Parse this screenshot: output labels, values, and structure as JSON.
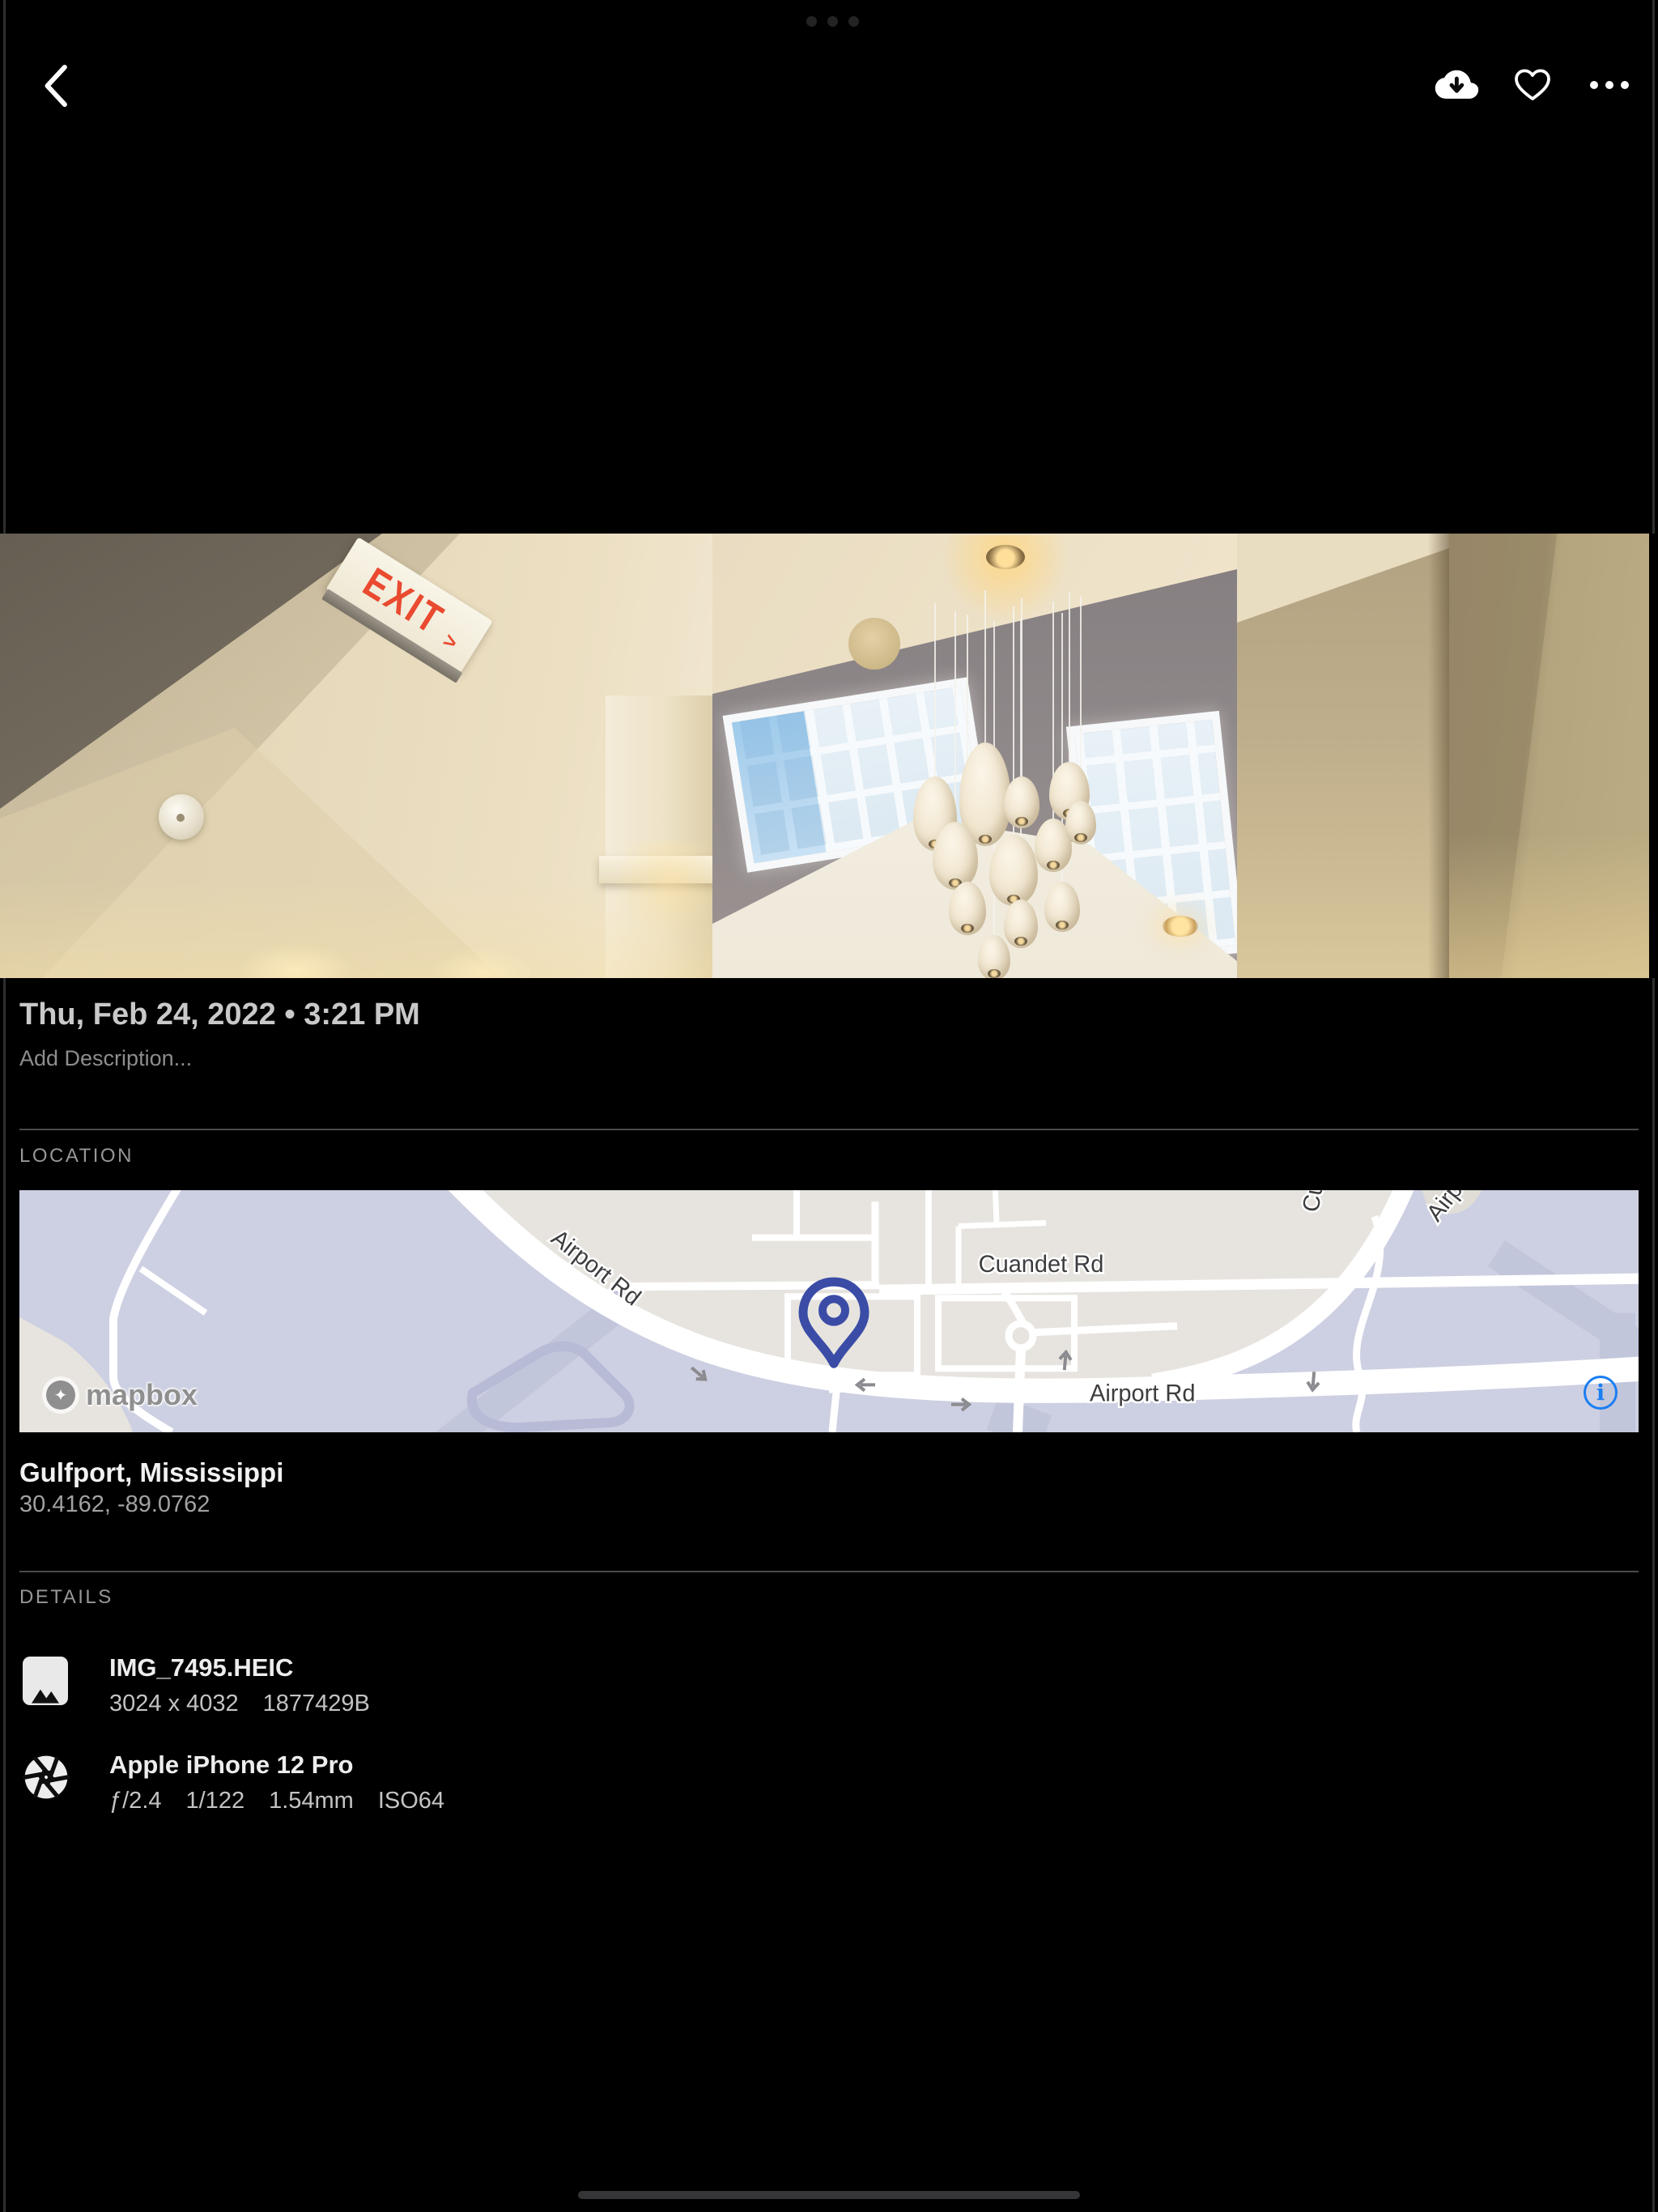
{
  "icons": {
    "back": "chevron-left",
    "download": "cloud-download",
    "favorite": "heart-outline",
    "more": "ellipsis-horizontal",
    "file": "image-thumbnail",
    "camera": "aperture",
    "map_info": "info-circle"
  },
  "photo": {
    "exit_sign": {
      "text": "EXIT",
      "arrow": ">"
    }
  },
  "meta": {
    "date": "Thu, Feb 24, 2022 • 3:21 PM",
    "description_placeholder": "Add Description..."
  },
  "location": {
    "title": "LOCATION",
    "place": "Gulfport, Mississippi",
    "coordinates": "30.4162, -89.0762",
    "map": {
      "attribution": "mapbox",
      "info_glyph": "i",
      "labels": {
        "airport_rd": "Airport Rd",
        "cuandet_rd": "Cuandet Rd"
      }
    }
  },
  "details": {
    "title": "DETAILS",
    "file": {
      "name": "IMG_7495.HEIC",
      "dimensions": "3024 x 4032",
      "size": "1877429B"
    },
    "camera": {
      "name": "Apple iPhone 12 Pro",
      "aperture": "ƒ/2.4",
      "shutter_speed": "1/122",
      "focal_length": "1.54mm",
      "iso": "ISO64"
    }
  },
  "colors": {
    "background": "#000000",
    "accent_blue": "#1b7ef2",
    "pin_blue": "#3a4ca6",
    "exit_red": "#e94a30",
    "map_land": "#e7e4df",
    "map_water": "#cdd0e2"
  }
}
